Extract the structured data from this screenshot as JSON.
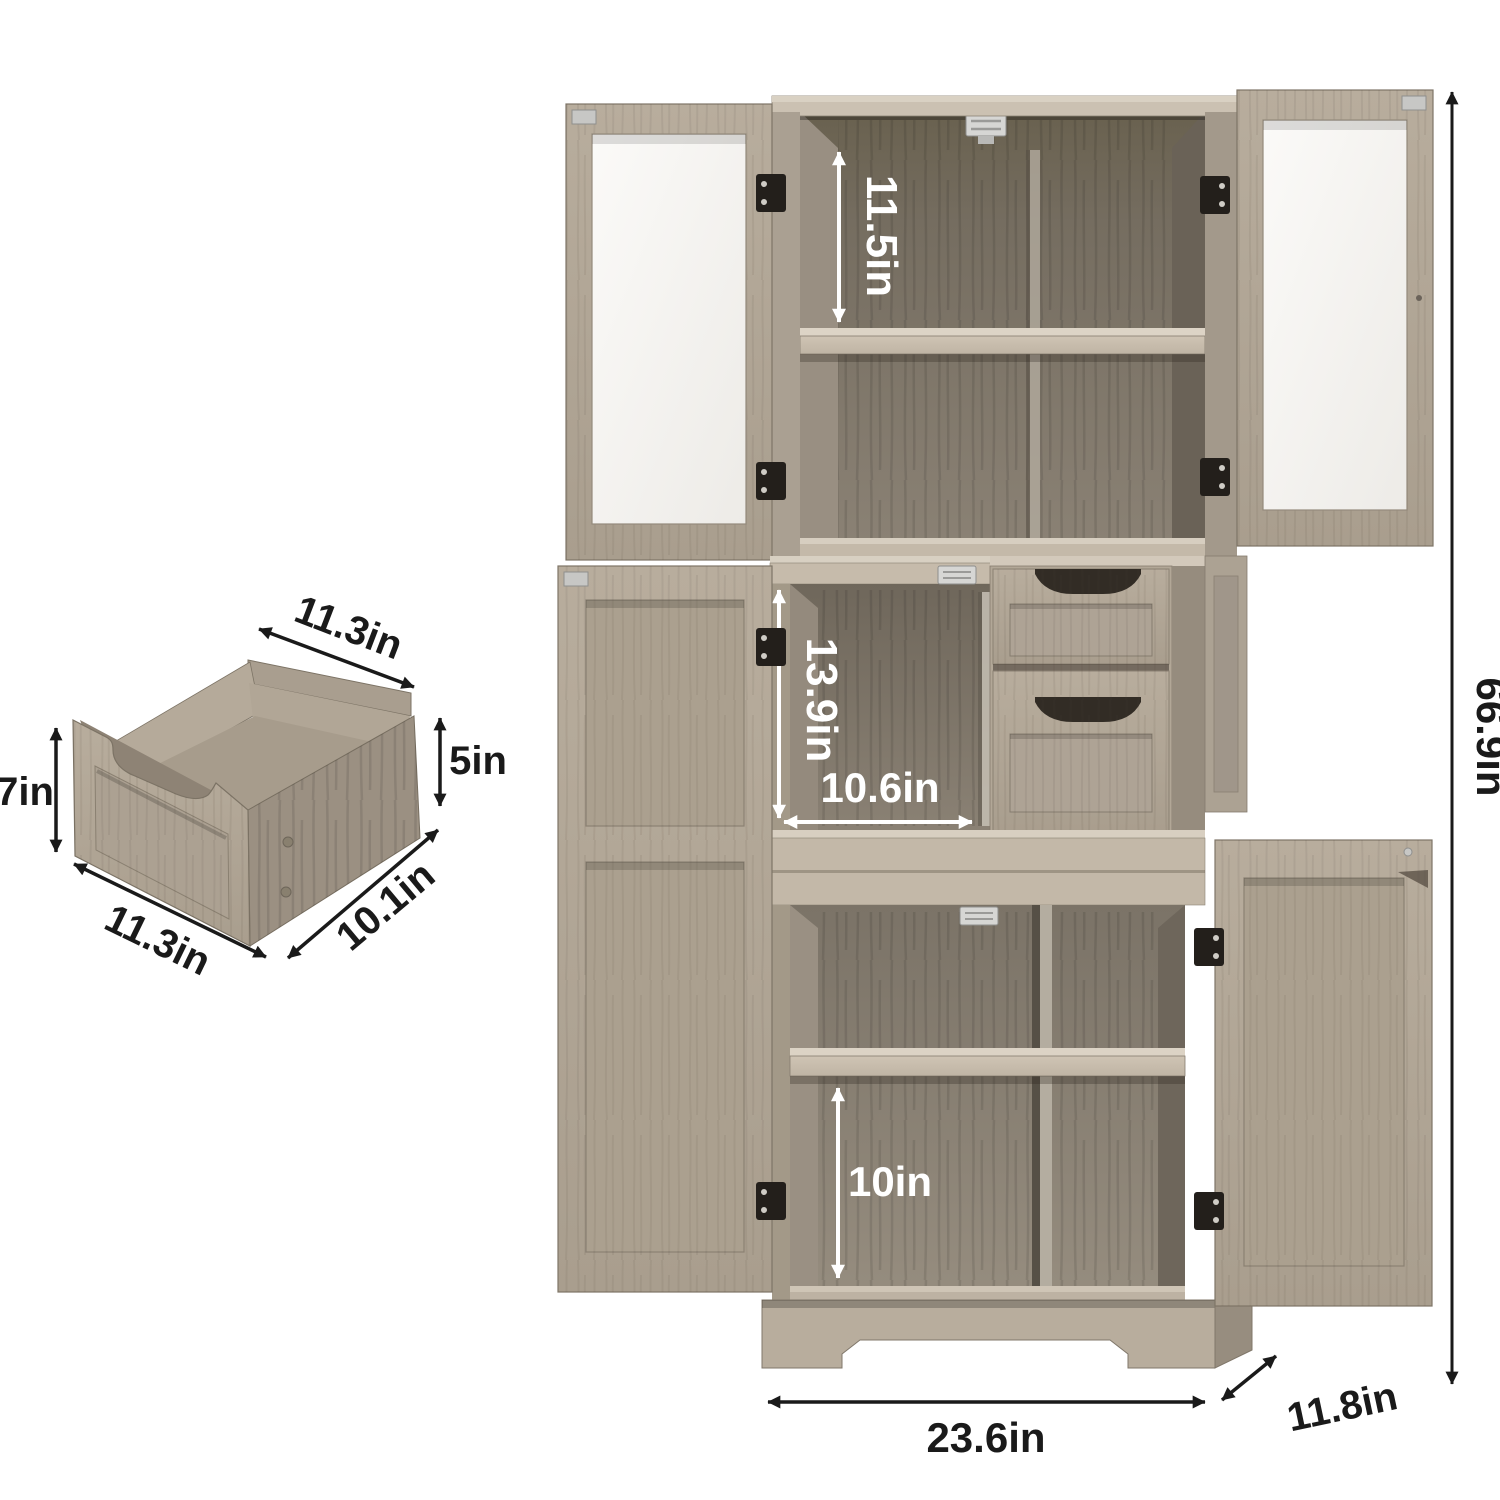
{
  "page": {
    "background": "#ffffff",
    "description": "Storage cabinet product dimension diagram"
  },
  "colors": {
    "wood_light": "#b6ab9b",
    "wood_mid": "#a89d8e",
    "wood_dark": "#8e8375",
    "interior_dark": "#756d61",
    "shelf_light": "#d8cfc1",
    "hinge_black": "#231f1b",
    "hardware_silver": "#d2d2d0",
    "dimension_black": "#1a1a1a",
    "dimension_white": "#ffffff",
    "glass_white": "#f8f7f5"
  },
  "drawer_diagram": {
    "name": "pull-out drawer dimensions",
    "labels": {
      "top_width": "11.3in",
      "side_height": "5in",
      "front_height": "7in",
      "front_width": "11.3in",
      "depth": "10.1in"
    }
  },
  "cabinet_diagram": {
    "name": "storage cabinet dimensions",
    "labels": {
      "top_compartment_height": "11.5in",
      "middle_compartment_height": "13.9in",
      "middle_compartment_width": "10.6in",
      "bottom_compartment_height": "10in",
      "overall_width": "23.6in",
      "depth": "11.8in",
      "overall_height": "66.9in"
    }
  }
}
